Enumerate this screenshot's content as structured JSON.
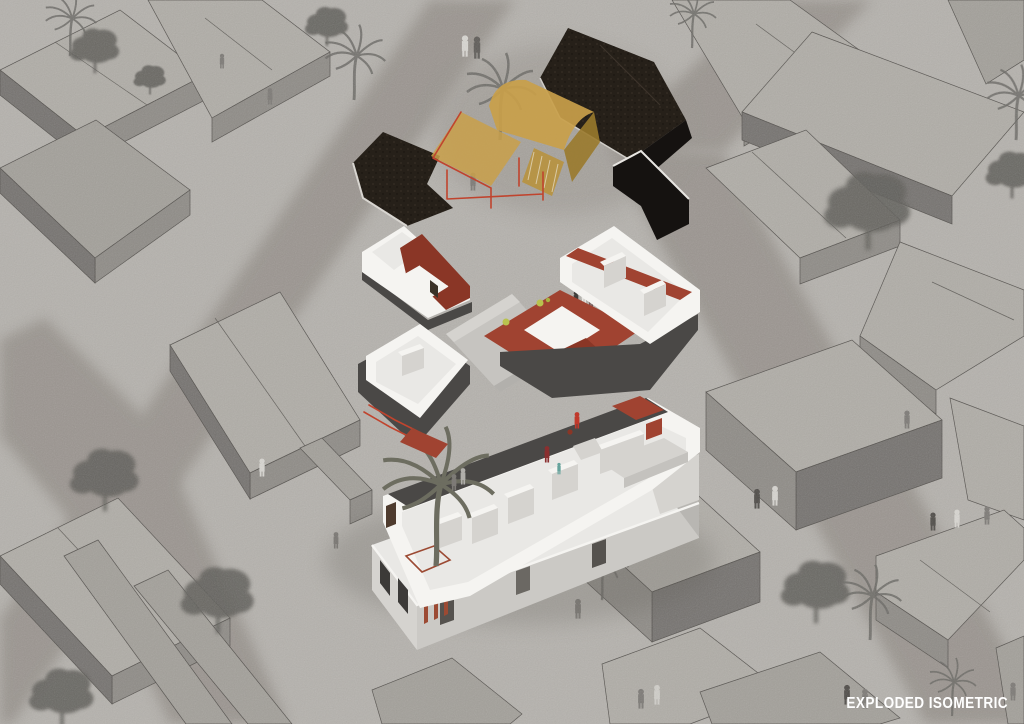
{
  "title": {
    "label": "EXPLODED ISOMETRIC"
  },
  "palette": {
    "bg": "#b5b2ad",
    "street": "#857f78",
    "outline": "#55524e",
    "blockTop": "#b0ada7",
    "blockTop2": "#a3a09a",
    "blockSide": "#8f8c87",
    "blockDark": "#767370",
    "whiteWall": "#f5f4f1",
    "innerFloor": "#e9e8e5",
    "floorGray": "#d5d3cf",
    "charcoal": "#4a4846",
    "redFloor": "#a04331",
    "redDark": "#8a3626",
    "rust": "#9c4a33",
    "amber": "#c9a04a",
    "amberDark": "#9a7a2c",
    "amberFace": "#b8923e",
    "redFrame": "#c0442e",
    "roofDark": "#262019",
    "roofDark2": "#151210",
    "treeColor": "#615e5a",
    "palmColor": "#6b6965",
    "personColor": "#7d7a76",
    "plantGreen": "#b9c24e",
    "labelColor": "#ffffff"
  },
  "scene": {
    "layers": [
      "roof-canopy",
      "upper-floor",
      "ground-floor",
      "site-base"
    ],
    "trees": [
      {
        "x": 95,
        "y": 48,
        "s": 1.15
      },
      {
        "x": 327,
        "y": 24,
        "s": 1.0
      },
      {
        "x": 150,
        "y": 78,
        "s": 0.75
      },
      {
        "x": 105,
        "y": 476,
        "s": 1.6
      },
      {
        "x": 218,
        "y": 596,
        "s": 1.7
      },
      {
        "x": 62,
        "y": 694,
        "s": 1.5
      },
      {
        "x": 868,
        "y": 206,
        "s": 2.0
      },
      {
        "x": 1012,
        "y": 172,
        "s": 1.2
      },
      {
        "x": 816,
        "y": 588,
        "s": 1.6
      }
    ],
    "palms": [
      {
        "x": 70,
        "y": 56,
        "s": 1.1
      },
      {
        "x": 354,
        "y": 100,
        "s": 1.3
      },
      {
        "x": 500,
        "y": 140,
        "s": 1.5
      },
      {
        "x": 692,
        "y": 48,
        "s": 1.0
      },
      {
        "x": 1016,
        "y": 140,
        "s": 1.3
      },
      {
        "x": 870,
        "y": 640,
        "s": 1.3
      },
      {
        "x": 952,
        "y": 716,
        "s": 1.0
      },
      {
        "x": 602,
        "y": 600,
        "s": 1.1
      }
    ],
    "people_context": [
      {
        "x": 465,
        "y": 56,
        "s": 1.3,
        "c": "#d8d6d1"
      },
      {
        "x": 477,
        "y": 58,
        "s": 1.35,
        "c": "#5f5c58"
      },
      {
        "x": 270,
        "y": 104,
        "s": 1.0
      },
      {
        "x": 222,
        "y": 68,
        "s": 0.9
      },
      {
        "x": 473,
        "y": 190,
        "s": 1.1
      },
      {
        "x": 262,
        "y": 476,
        "s": 1.1,
        "c": "#d8d6d1"
      },
      {
        "x": 336,
        "y": 548,
        "s": 1.0
      },
      {
        "x": 408,
        "y": 596,
        "s": 1.1
      },
      {
        "x": 421,
        "y": 599,
        "s": 1.1,
        "c": "#cfcdc8"
      },
      {
        "x": 524,
        "y": 594,
        "s": 1.0,
        "c": "#d5d3ce"
      },
      {
        "x": 537,
        "y": 590,
        "s": 1.0
      },
      {
        "x": 548,
        "y": 595,
        "s": 0.65
      },
      {
        "x": 578,
        "y": 618,
        "s": 1.2
      },
      {
        "x": 641,
        "y": 708,
        "s": 1.2
      },
      {
        "x": 657,
        "y": 704,
        "s": 1.2,
        "c": "#d0cec9"
      },
      {
        "x": 757,
        "y": 508,
        "s": 1.2,
        "c": "#4f4c48"
      },
      {
        "x": 775,
        "y": 505,
        "s": 1.2,
        "c": "#d6d4cf"
      },
      {
        "x": 907,
        "y": 428,
        "s": 1.1
      },
      {
        "x": 933,
        "y": 530,
        "s": 1.1,
        "c": "#4f4c48"
      },
      {
        "x": 957,
        "y": 527,
        "s": 1.1,
        "c": "#d8d6d1"
      },
      {
        "x": 987,
        "y": 524,
        "s": 1.1
      },
      {
        "x": 847,
        "y": 704,
        "s": 1.2,
        "c": "#4f4c48"
      },
      {
        "x": 865,
        "y": 708,
        "s": 1.2
      },
      {
        "x": 1013,
        "y": 700,
        "s": 1.1
      }
    ],
    "people_building": [
      {
        "x": 391,
        "y": 262,
        "s": 0.95,
        "c": "#8a8f99"
      },
      {
        "x": 398,
        "y": 260,
        "s": 0.95,
        "c": "#c9804a"
      },
      {
        "x": 576,
        "y": 306,
        "s": 0.95,
        "c": "#3f3d3b"
      },
      {
        "x": 584,
        "y": 303,
        "s": 0.95,
        "c": "#e8e6e2"
      },
      {
        "x": 591,
        "y": 306,
        "s": 0.9,
        "c": "#6b4a4a"
      },
      {
        "x": 537,
        "y": 342,
        "s": 1.0,
        "c": "#e0cb4e"
      },
      {
        "x": 546,
        "y": 339,
        "s": 1.0,
        "c": "#e4e2dd"
      },
      {
        "x": 554,
        "y": 342,
        "s": 0.95,
        "c": "#66a39c"
      },
      {
        "x": 542,
        "y": 355,
        "s": 0.9,
        "c": "#d8d6d1"
      },
      {
        "x": 550,
        "y": 366,
        "s": 0.95,
        "c": "#c9c7c2"
      },
      {
        "x": 399,
        "y": 398,
        "s": 0.95,
        "c": "#8aa4b8"
      },
      {
        "x": 454,
        "y": 490,
        "s": 1.0,
        "c": "#7d7a76"
      },
      {
        "x": 463,
        "y": 484,
        "s": 1.0,
        "c": "#b0aeaa"
      },
      {
        "x": 547,
        "y": 462,
        "s": 1.0,
        "c": "#8a2f2f"
      },
      {
        "x": 559,
        "y": 474,
        "s": 0.7,
        "c": "#66a39c"
      },
      {
        "x": 577,
        "y": 428,
        "s": 1.0,
        "c": "#c0392b"
      }
    ]
  }
}
